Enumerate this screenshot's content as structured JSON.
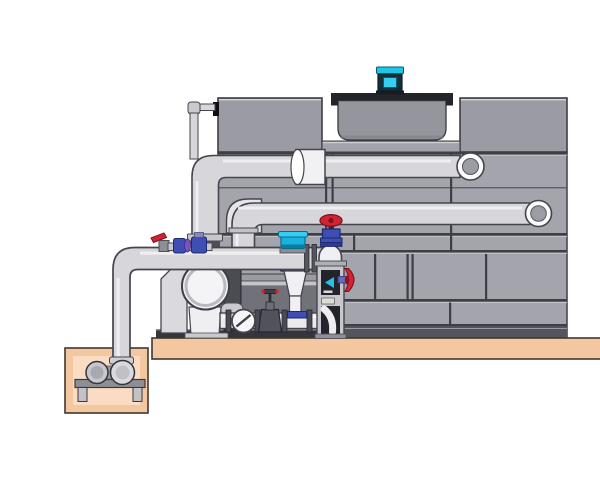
{
  "figure": {
    "title": "Cooling tower with pump skid and sump piping (technical illustration)",
    "background": "#ffffff"
  },
  "colors": {
    "ground_tan": "#f3c7a0",
    "pit_inner": "#f9dcc2",
    "ground_outline": "#42372e",
    "tower_body": "#a4a4ac",
    "tower_box": "#9b9ba3",
    "tower_base_dark": "#54545c",
    "seam_dark": "#3e3e46",
    "seam_light": "#c9c9cf",
    "deck_band": "#a2a2aa",
    "fan_deck_dark": "#24242a",
    "cowl_gray": "#95959d",
    "motor_cyan": "#1ec6e8",
    "motor_cyan_light": "#35cdf2",
    "motor_dark": "#143038",
    "pipe_fill": "#d6d6db",
    "pipe_outline": "#45454b",
    "pipe_highlight": "#f3f3f6",
    "pipe_inner": "#9b9ca4",
    "collar_white": "#f1f1f4",
    "pump_white": "#f4f4f6",
    "plate_gray": "#dadade",
    "skid_gray": "#9a9aa1",
    "recess_dark": "#71717a",
    "skid_base_dark": "#35353d",
    "manifold_white": "#ebebed",
    "flange_dark": "#4a4a54",
    "valve_red": "#d22331",
    "valve_blue": "#3e4eb2",
    "valve_purple": "#7a52c2",
    "device_cyan": "#18b4de",
    "column_gray": "#c6c6cc",
    "inset_dark": "#23232b",
    "motor_block_dark": "#4b4b53"
  },
  "components": {
    "cooling_tower": "cooling tower casing with paneled face",
    "fan_motor": "cyan fan motor on fan deck",
    "fan_cowl": "fan cowl cylinder on tower top",
    "upper_distribution_pipe": "upper hot-water pipe with wall elbow",
    "lower_distribution_pipe": "lower distribution pipe with wall elbow",
    "makeup_line": "small makeup water line at tower top left",
    "main_header_pipe": "main header pipe from sump riser to riser valve",
    "riser_gate_valve": "gate valve with red handwheel",
    "side_valve": "red handwheel valve on column",
    "ball_valve_assembly": "red lever ball valve with blue valve bodies",
    "float_device": "cyan level device on header pipe",
    "cone_reducer": "cone reducer with blue flanges",
    "pump": "end-suction centrifugal pump on skid",
    "suction_manifold": "manifold with check valve and gate valve",
    "instrument_column": "column with indicator panels",
    "sump_pit": "sump pit with small pump and stand",
    "concrete_pad": "tan concrete pad"
  }
}
